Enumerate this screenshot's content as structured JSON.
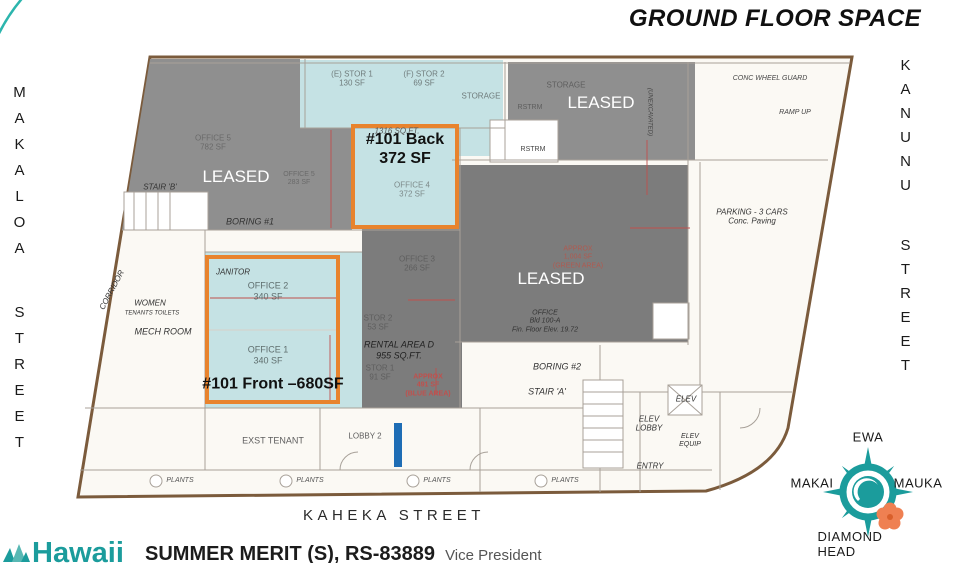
{
  "title": "GROUND FLOOR SPACE",
  "streets": {
    "left": "MAKALOA STREET",
    "right": "KANUNU STREET",
    "bottom": "KAHEKA STREET"
  },
  "compass": {
    "north": "EWA",
    "west": "MAKAI",
    "east": "MAUKA",
    "south": "DIAMOND HEAD"
  },
  "footer": {
    "brand": "Hawaii",
    "agent": "SUMMER MERIT (S), RS-83889",
    "agent_title": "Vice President"
  },
  "colors": {
    "teal": "#1b9c9c",
    "teal_area": "#c5e2e4",
    "orange": "#e8832d",
    "gray_leased": "#8f8f8f",
    "gray_dark": "#7c7c7c",
    "blue_bar": "#1e6db5",
    "red_note": "#c0504d",
    "outline_brown": "#7b5b3c",
    "wall_gray": "#a8a199",
    "flower_orange": "#ef8052"
  },
  "plan": {
    "labels": [
      {
        "name": "stor-e1",
        "t": "(E) STOR 1\n130 SF",
        "x": 352,
        "y": 79,
        "s": 8,
        "c": "#6f7b7b"
      },
      {
        "name": "stor-f2",
        "t": "(F) STOR 2\n69 SF",
        "x": 424,
        "y": 79,
        "s": 8,
        "c": "#6f7b7b"
      },
      {
        "name": "storage-teal",
        "t": "STORAGE",
        "x": 481,
        "y": 96,
        "s": 8,
        "c": "#6f7b7b"
      },
      {
        "name": "storage-gray",
        "t": "STORAGE",
        "x": 566,
        "y": 85,
        "s": 8,
        "c": "#5e5e5e"
      },
      {
        "name": "rstrm-upper",
        "t": "RSTRM",
        "x": 530,
        "y": 108,
        "s": 7,
        "c": "#5e5e5e"
      },
      {
        "name": "rstrm-lower",
        "t": "RSTRM",
        "x": 533,
        "y": 150,
        "s": 7,
        "c": "#444444"
      },
      {
        "name": "leased-topleft",
        "t": "LEASED",
        "x": 236,
        "y": 177,
        "s": 17,
        "c": "#ffffff"
      },
      {
        "name": "leased-topright",
        "t": "LEASED",
        "x": 601,
        "y": 103,
        "s": 17,
        "c": "#ffffff"
      },
      {
        "name": "leased-center",
        "t": "LEASED",
        "x": 551,
        "y": 279,
        "s": 17,
        "c": "#ffffff"
      },
      {
        "name": "unit-back",
        "t": "#101 Back\n372 SF",
        "x": 405,
        "y": 150,
        "s": 16,
        "c": "#111111",
        "w": "bold"
      },
      {
        "name": "office-4",
        "t": "OFFICE 4\n372 SF",
        "x": 412,
        "y": 190,
        "s": 8,
        "c": "#7d8a8a"
      },
      {
        "name": "sqft-1316",
        "t": "1316 SQ.FT.",
        "x": 397,
        "y": 131,
        "s": 8,
        "c": "#555555",
        "f": "hand"
      },
      {
        "name": "office-5a",
        "t": "OFFICE 5\n782 SF",
        "x": 213,
        "y": 143,
        "s": 8,
        "c": "#6a6a6a"
      },
      {
        "name": "office-5b",
        "t": "OFFICE 5\n283 SF",
        "x": 299,
        "y": 179,
        "s": 7,
        "c": "#6a6a6a"
      },
      {
        "name": "stair-b",
        "t": "STAIR 'B'",
        "x": 160,
        "y": 187,
        "s": 8,
        "c": "#333333",
        "f": "hand"
      },
      {
        "name": "boring-1",
        "t": "BORING #1",
        "x": 250,
        "y": 222,
        "s": 9,
        "c": "#333333",
        "f": "hand"
      },
      {
        "name": "janitor",
        "t": "JANITOR",
        "x": 233,
        "y": 272,
        "s": 8,
        "c": "#333333",
        "f": "hand"
      },
      {
        "name": "office-2",
        "t": "OFFICE 2\n340 SF",
        "x": 268,
        "y": 291,
        "s": 9,
        "c": "#5f6e6e"
      },
      {
        "name": "women",
        "t": "WOMEN",
        "x": 150,
        "y": 303,
        "s": 8,
        "c": "#333333",
        "f": "hand"
      },
      {
        "name": "tenants-toilets",
        "t": "TENANTS TOILETS",
        "x": 152,
        "y": 314,
        "s": 6,
        "c": "#333333",
        "f": "hand"
      },
      {
        "name": "mech-room",
        "t": "MECH ROOM",
        "x": 163,
        "y": 332,
        "s": 9,
        "c": "#333333",
        "f": "hand"
      },
      {
        "name": "corridor",
        "t": "CORRIDOR",
        "x": 112,
        "y": 290,
        "s": 8,
        "c": "#333333",
        "r": -62,
        "f": "hand"
      },
      {
        "name": "office-1",
        "t": "OFFICE 1\n340 SF",
        "x": 268,
        "y": 355,
        "s": 9,
        "c": "#5f6e6e"
      },
      {
        "name": "unit-front",
        "t": "#101 Front –680SF",
        "x": 273,
        "y": 385,
        "s": 16,
        "c": "#111111",
        "w": "bold"
      },
      {
        "name": "office-3",
        "t": "OFFICE 3\n266 SF",
        "x": 417,
        "y": 264,
        "s": 8,
        "c": "#5e5e5e"
      },
      {
        "name": "stor-2",
        "t": "STOR 2\n53 SF",
        "x": 378,
        "y": 323,
        "s": 8,
        "c": "#5e5e5e"
      },
      {
        "name": "rental-area-d",
        "t": "RENTAL AREA D\n955 SQ.FT.",
        "x": 399,
        "y": 350,
        "s": 9,
        "c": "#222222",
        "f": "hand"
      },
      {
        "name": "stor-1",
        "t": "STOR 1\n91 SF",
        "x": 380,
        "y": 373,
        "s": 8,
        "c": "#5e5e5e"
      },
      {
        "name": "approx-blue",
        "t": "APPROX\n491 SF\n(BLUE AREA)",
        "x": 428,
        "y": 386,
        "s": 7,
        "c": "#c0504d",
        "w": "bold"
      },
      {
        "name": "approx-green",
        "t": "APPROX\n1,004 SF\n(GREEN AREA)",
        "x": 578,
        "y": 258,
        "s": 7,
        "c": "#b05a50"
      },
      {
        "name": "office-100a",
        "t": "OFFICE\nBld 100-A\nFin. Floor Elev. 19.72",
        "x": 545,
        "y": 322,
        "s": 7,
        "c": "#333333",
        "f": "hand"
      },
      {
        "name": "boring-2",
        "t": "BORING #2",
        "x": 557,
        "y": 367,
        "s": 9,
        "c": "#333333",
        "f": "hand"
      },
      {
        "name": "stair-a",
        "t": "STAIR 'A'",
        "x": 547,
        "y": 392,
        "s": 9,
        "c": "#333333",
        "f": "hand"
      },
      {
        "name": "elev",
        "t": "ELEV",
        "x": 686,
        "y": 399,
        "s": 8,
        "c": "#333333",
        "f": "hand"
      },
      {
        "name": "elev-lobby",
        "t": "ELEV\nLOBBY",
        "x": 649,
        "y": 424,
        "s": 8,
        "c": "#333333",
        "f": "hand"
      },
      {
        "name": "elev-equip",
        "t": "ELEV\nEQUIP",
        "x": 690,
        "y": 441,
        "s": 7,
        "c": "#333333",
        "f": "hand"
      },
      {
        "name": "entry",
        "t": "ENTRY",
        "x": 650,
        "y": 466,
        "s": 8,
        "c": "#333333",
        "f": "hand"
      },
      {
        "name": "parking",
        "t": "PARKING - 3 CARS\nConc. Paving",
        "x": 752,
        "y": 217,
        "s": 8,
        "c": "#333333",
        "f": "hand"
      },
      {
        "name": "wheel-guard",
        "t": "CONC WHEEL GUARD",
        "x": 770,
        "y": 79,
        "s": 7,
        "c": "#444444",
        "f": "hand"
      },
      {
        "name": "ramp-up",
        "t": "RAMP UP",
        "x": 795,
        "y": 113,
        "s": 7,
        "c": "#444444",
        "f": "hand"
      },
      {
        "name": "unexcavated",
        "t": "(UNEXCAVATED)",
        "x": 649,
        "y": 112,
        "s": 6,
        "c": "#444444",
        "r": 90,
        "f": "hand"
      },
      {
        "name": "exst-tenant",
        "t": "EXST TENANT",
        "x": 273,
        "y": 441,
        "s": 9,
        "c": "#5e5e5e"
      },
      {
        "name": "lobby-2",
        "t": "LOBBY 2",
        "x": 365,
        "y": 436,
        "s": 8,
        "c": "#5e5e5e"
      },
      {
        "name": "plants-1",
        "t": "PLANTS",
        "x": 180,
        "y": 481,
        "s": 7,
        "c": "#555555",
        "f": "hand"
      },
      {
        "name": "plants-2",
        "t": "PLANTS",
        "x": 310,
        "y": 481,
        "s": 7,
        "c": "#555555",
        "f": "hand"
      },
      {
        "name": "plants-3",
        "t": "PLANTS",
        "x": 437,
        "y": 481,
        "s": 7,
        "c": "#555555",
        "f": "hand"
      },
      {
        "name": "plants-4",
        "t": "PLANTS",
        "x": 565,
        "y": 481,
        "s": 7,
        "c": "#555555",
        "f": "hand"
      }
    ]
  }
}
